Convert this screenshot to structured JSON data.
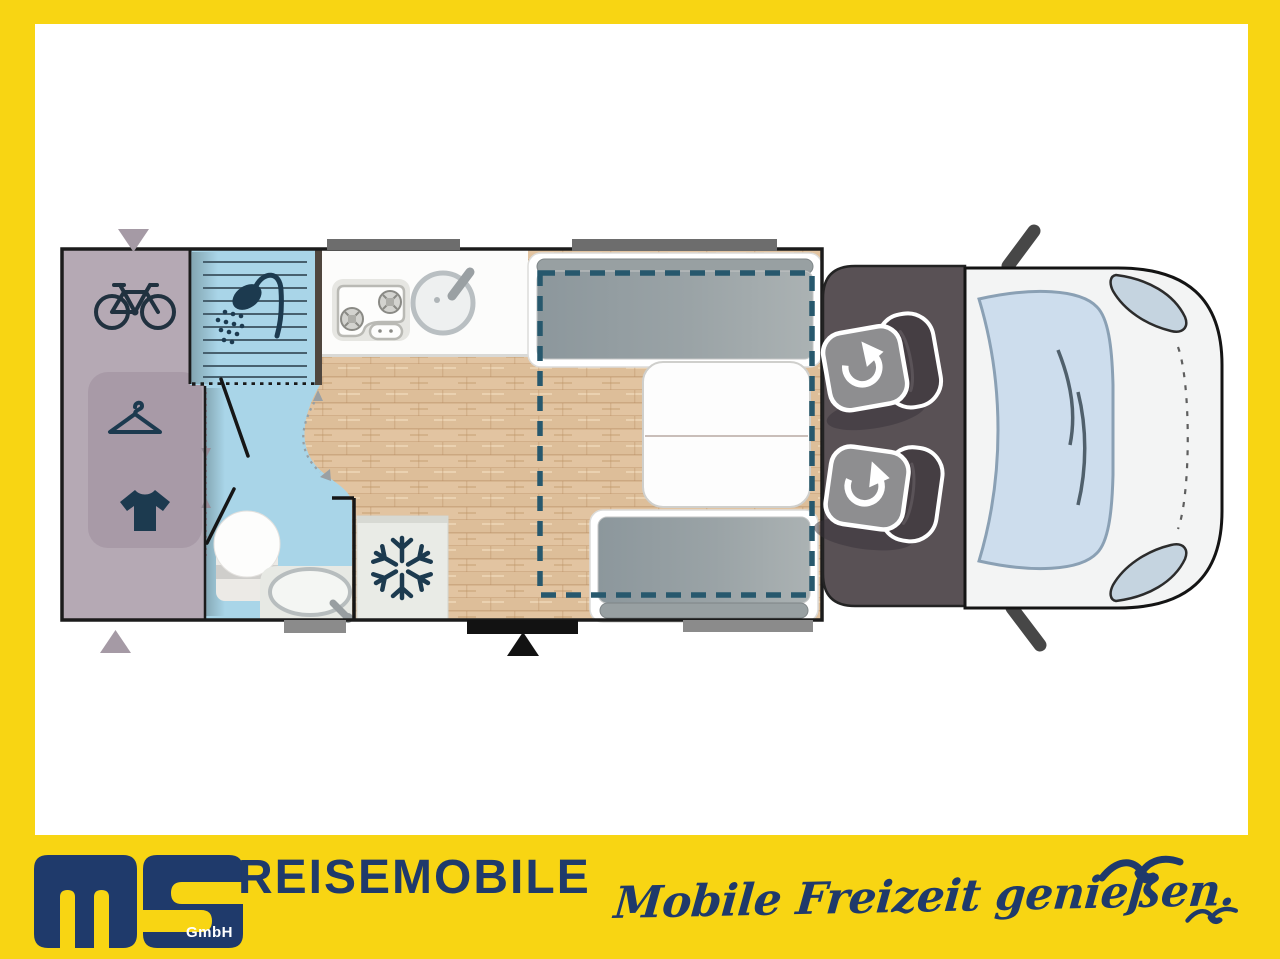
{
  "theme": {
    "yellow": "#F8D513",
    "navy": "#1F3A6B",
    "mauve": "#B5A9B4",
    "bath": "#A9D5E8",
    "planicon": "#1C3A4F",
    "beddash": "#27586D",
    "wood": "#E2C4A1"
  },
  "brand": {
    "logo_letters": "MS",
    "gmbh": "GmbH",
    "name": "REISEMOBILE",
    "slogan": "Mobile Freizeit genießen."
  },
  "floorplan": {
    "type": "motorhome-top-view",
    "rooms": [
      "rear-garage-with-wardrobe",
      "shower-bathroom",
      "kitchen-block",
      "dinette-with-drop-down-bed",
      "driver-cab-with-swivel-seats"
    ],
    "icons": [
      "bicycle-icon",
      "clothes-hanger-icon",
      "tshirt-icon",
      "shower-icon",
      "stove-icon",
      "kitchen-sink-icon",
      "toilet-icon",
      "washbasin-icon",
      "snowflake-icon",
      "swivel-seat-rotation-icon",
      "drop-down-bed-outline",
      "entry-door-marker",
      "window-marker",
      "roof-vent-arrow",
      "seagull-icon"
    ]
  }
}
